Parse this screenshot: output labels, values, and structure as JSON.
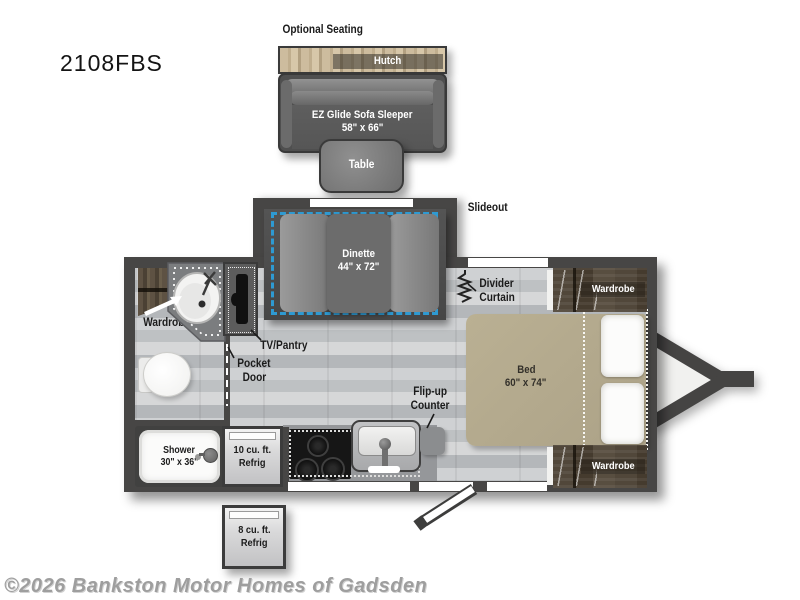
{
  "page": {
    "model": "2108FBS",
    "watermark": "©2026 Bankston Motor Homes of Gadsden"
  },
  "colors": {
    "wall": "#474645",
    "accent_blue": "#2e9ad2",
    "bed_tan": "#b3a98f",
    "wood_light": "#c6b494",
    "wood_dark": "#4d4335",
    "floor_gray": "#c8cacc",
    "dinette_floor": "#4e4e4e"
  },
  "optional_seating": {
    "title": "Optional Seating",
    "hutch": "Hutch",
    "sofa_line1": "EZ Glide Sofa Sleeper",
    "sofa_line2": "58\" x 66\"",
    "table": "Table"
  },
  "slideout": {
    "label": "Slideout",
    "dinette_line1": "Dinette",
    "dinette_line2": "44\" x 72\""
  },
  "bedroom": {
    "divider_line1": "Divider",
    "divider_line2": "Curtain",
    "bed_line1": "Bed",
    "bed_line2": "60\" x 74\"",
    "wardrobe_rear": "Wardrobe",
    "wardrobe_front": "Wardrobe"
  },
  "bathroom": {
    "wardrobe": "Wardrobe",
    "tv_pantry": "TV/Pantry",
    "pocket_line1": "Pocket",
    "pocket_line2": "Door",
    "shower_line1": "Shower",
    "shower_line2": "30\" x 36\""
  },
  "kitchen": {
    "fridge10_line1": "10 cu. ft.",
    "fridge10_line2": "Refrig",
    "flip_line1": "Flip-up",
    "flip_line2": "Counter",
    "fridge8_line1": "8 cu. ft.",
    "fridge8_line2": "Refrig"
  }
}
